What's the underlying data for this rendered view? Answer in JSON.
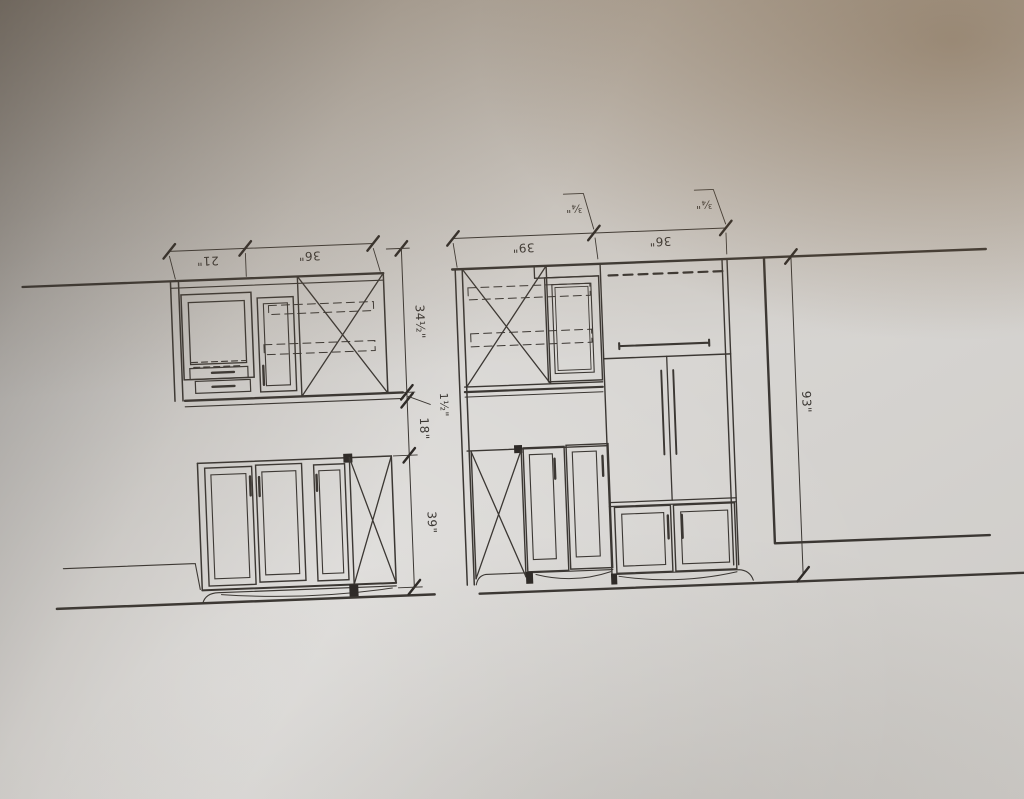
{
  "photo": {
    "paper_color": "#d7d5d2",
    "line_color": "#3b3733",
    "shadow_top_left_color": "#4a4238",
    "shadow_tan_color": "#8a6e4c"
  },
  "left_elevation": {
    "width_dims": [
      "21\"",
      "36\""
    ],
    "height_dims": [
      "34½\"",
      "1½\"",
      "18\"",
      "39\""
    ]
  },
  "right_elevation": {
    "width_dims": [
      "39\"",
      "36\""
    ],
    "filler_dims": [
      "¾\"",
      "¾\""
    ],
    "height_dims": [
      "93\""
    ]
  }
}
